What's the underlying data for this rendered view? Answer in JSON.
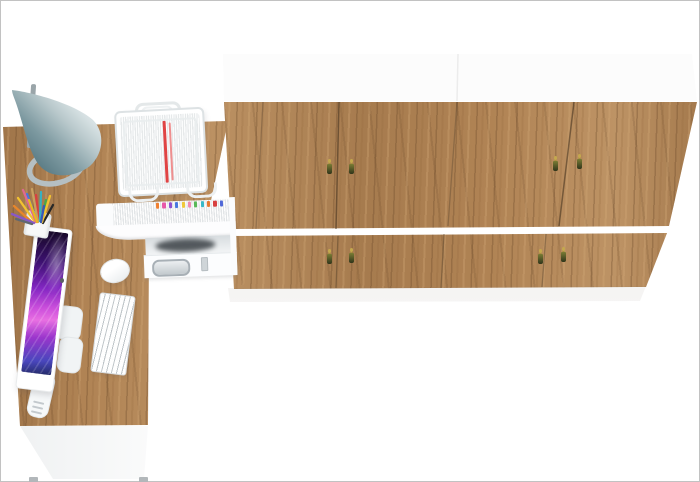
{
  "scene": {
    "description": "Top-down 3D render of a home office: L-shaped oak desk with all-in-one computer, keyboard, mouse, desk lamp, pencil cup, wire document tray, white organizer hutch with drawer, and a wall of oak double-door wardrobes",
    "background": "#ffffff",
    "frame_border": "#c2c2c2"
  },
  "wardrobe": {
    "label": "Oak wardrobe wall unit with two door rows and tassel key handles",
    "wood_base": "#b08354",
    "top_panel": "#fcfcfc",
    "door_rows": 2,
    "door_columns": 4,
    "seam_color_upper": "rgba(62,46,28,0.55)",
    "seam_color_lower": "rgba(84,64,42,0.45)",
    "handle_count": 8,
    "handle_key_color": "#c4a84e",
    "handle_key_shade": "#a8903e",
    "handle_tassel_top": "#7a7c34",
    "handle_tassel_bottom": "#2f341a",
    "floor_shadow": "rgba(128,116,102,0.20)"
  },
  "desk": {
    "label": "L-shaped oak desk with white front panel",
    "wood_base": "#b08354",
    "front_panel": "#f4f5f6",
    "feet_color": "#b2b7ba"
  },
  "hutch": {
    "label": "White desktop organizer: book shelf, open compartment, drawer",
    "body_color": "#fcfdfe",
    "file_tab_colors": [
      "#f08030",
      "#e858a8",
      "#9050d0",
      "#4878e0",
      "#f0c838",
      "#f088b0",
      "#58b858",
      "#38b8c8",
      "#e87830",
      "#d84040",
      "#5068d8"
    ],
    "drawer_handle_color": "#a8b0b6",
    "compartment_shadow": "#3a4045"
  },
  "document_tray": {
    "label": "White wire document tray holding a paper stack with red folder stripes",
    "wire_color": "#dde2e4",
    "paper_color": "#fafbfb",
    "red_stripe_strong": "#e04444",
    "red_stripe_faint": "#ef8f8f"
  },
  "lamp": {
    "label": "Desk lamp with teal cone shade, gray arm and ring base",
    "shade_dark": "#4f727c",
    "shade_mid": "#7e9aa1",
    "shade_light": "#d8e2e4",
    "base_ring_color": "#b5bfc2",
    "arm_color": "#9aa5a9"
  },
  "computer": {
    "label": "All-in-one computer showing purple abstract wallpaper",
    "bezel_color": "#ffffff",
    "screen_colors": [
      "#150823",
      "#8226c2",
      "#cc4fdc",
      "#e86fe2",
      "#4946bd"
    ],
    "stand_color": "#f5f7f8"
  },
  "keyboard": {
    "label": "White wireless keyboard",
    "color": "#eef1f2"
  },
  "mouse": {
    "label": "White mouse",
    "color": "#fdfdfe"
  },
  "pencil_cup": {
    "label": "White pencil cup with colored pens",
    "cup_color": "#f7f8f8",
    "pencil_colors": [
      "#f2c230",
      "#4878d8",
      "#d84040",
      "#48a848",
      "#282828",
      "#e8862a",
      "#e06890",
      "#38b0c0",
      "#8858c8",
      "#c8a060",
      "#f2c230",
      "#606870",
      "#e8b820",
      "#3858b8"
    ]
  }
}
